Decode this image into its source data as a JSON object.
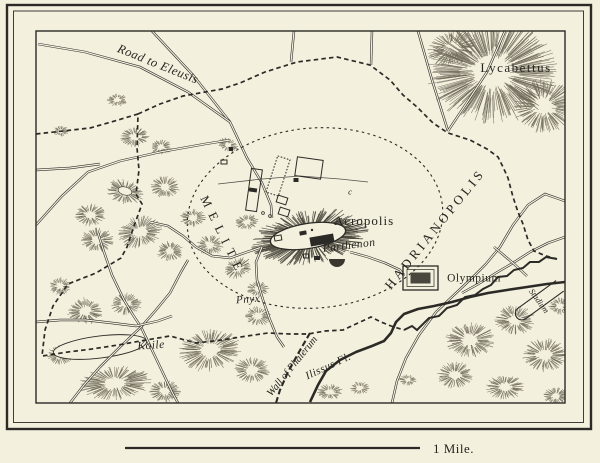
{
  "title": "Map of ancient Athens",
  "colors": {
    "background": "#f4f0de",
    "ink": "#2b2a26",
    "hachure": "#6f6a5a",
    "hachure_dark": "#4a473c",
    "label": "#26251f",
    "water": "#2b2a26"
  },
  "scale_bar": {
    "label": "1 Mile.",
    "x1": 125,
    "x2": 420,
    "y": 448,
    "label_x": 433,
    "label_y": 453,
    "size": 13
  },
  "labels": [
    {
      "id": "road-to-eleusis",
      "text": "Road to Eleusis",
      "x": 158,
      "y": 64,
      "rot": 22,
      "size": 12.5,
      "style": "italic",
      "spacing": 0.5
    },
    {
      "id": "lycabettus",
      "text": "Lycabettus",
      "x": 516,
      "y": 68,
      "rot": 0,
      "size": 13,
      "style": "roman",
      "spacing": 1.5
    },
    {
      "id": "melite",
      "text": "MELITE",
      "x": 223,
      "y": 236,
      "rot": 64,
      "size": 12.5,
      "style": "caps",
      "spacing": 7
    },
    {
      "id": "acropolis",
      "text": "Acropolis",
      "x": 364,
      "y": 221,
      "rot": 0,
      "size": 13,
      "style": "roman",
      "spacing": 1
    },
    {
      "id": "parthenon",
      "text": "Parthenon",
      "x": 349,
      "y": 245,
      "rot": -7,
      "size": 11.5,
      "style": "italic",
      "spacing": 0.5
    },
    {
      "id": "hadrianopolis",
      "text": "HADRIANOPOLIS",
      "x": 435,
      "y": 229,
      "rot": -51,
      "size": 13,
      "style": "caps",
      "spacing": 3.5
    },
    {
      "id": "olympium",
      "text": "Olympium",
      "x": 474,
      "y": 278,
      "rot": 0,
      "size": 11.5,
      "style": "roman",
      "spacing": 0.5
    },
    {
      "id": "pnyx",
      "text": "Pnyx",
      "x": 248,
      "y": 299,
      "rot": -4,
      "size": 11,
      "style": "italic",
      "spacing": 0.5
    },
    {
      "id": "koile",
      "text": "Koile",
      "x": 151,
      "y": 345,
      "rot": -4,
      "size": 11.5,
      "style": "italic",
      "spacing": 0.5
    },
    {
      "id": "wall-of-phalerum",
      "text": "Wall of Phalerum",
      "x": 292,
      "y": 366,
      "rot": -51,
      "size": 10.5,
      "style": "italic",
      "spacing": 0
    },
    {
      "id": "ilissus-fl",
      "text": "Ilissus Fl.",
      "x": 328,
      "y": 366,
      "rot": -25,
      "size": 11,
      "style": "italic",
      "spacing": 0.5
    },
    {
      "id": "stadium",
      "text": "Stadium",
      "x": 539,
      "y": 301,
      "rot": 54,
      "size": 8.5,
      "style": "italic",
      "spacing": 0
    },
    {
      "id": "map-mark-c",
      "text": "c",
      "x": 350,
      "y": 192,
      "rot": 0,
      "size": 8.5,
      "style": "italic",
      "spacing": 0
    }
  ],
  "frame": {
    "outer": {
      "x": 7,
      "y": 5,
      "w": 584,
      "h": 424,
      "sw": 2.4
    },
    "mid": {
      "x": 13.5,
      "y": 11,
      "w": 570,
      "h": 411.5,
      "sw": 0.9
    },
    "map": {
      "x": 36,
      "y": 31,
      "w": 529,
      "h": 372,
      "sw": 1.4
    }
  },
  "walls": {
    "west_south": [
      [
        36,
        134
      ],
      [
        90,
        128
      ],
      [
        118,
        120
      ],
      [
        138,
        114
      ],
      [
        137,
        148
      ],
      [
        139,
        170
      ],
      [
        136,
        194
      ],
      [
        142,
        204
      ],
      [
        134,
        226
      ],
      [
        127,
        247
      ],
      [
        121,
        258
      ],
      [
        96,
        273
      ],
      [
        68,
        284
      ],
      [
        53,
        306
      ],
      [
        45,
        330
      ],
      [
        42,
        356
      ],
      [
        68,
        352
      ],
      [
        92,
        349
      ],
      [
        118,
        345
      ],
      [
        146,
        340
      ],
      [
        170,
        336
      ],
      [
        196,
        343
      ],
      [
        222,
        340
      ],
      [
        247,
        336
      ],
      [
        268,
        333
      ],
      [
        290,
        334
      ],
      [
        308,
        334
      ],
      [
        325,
        331
      ],
      [
        343,
        330
      ],
      [
        358,
        323
      ],
      [
        371,
        317
      ],
      [
        381,
        322
      ],
      [
        391,
        326
      ],
      [
        404,
        330
      ]
    ],
    "north_east": [
      [
        138,
        114
      ],
      [
        160,
        104
      ],
      [
        183,
        96
      ],
      [
        222,
        89
      ],
      [
        240,
        83
      ],
      [
        265,
        72
      ],
      [
        297,
        62
      ],
      [
        337,
        57
      ],
      [
        370,
        65
      ],
      [
        390,
        80
      ],
      [
        403,
        95
      ],
      [
        417,
        107
      ],
      [
        427,
        117
      ],
      [
        433,
        123
      ],
      [
        448,
        133
      ],
      [
        470,
        140
      ],
      [
        487,
        149
      ],
      [
        498,
        157
      ],
      [
        503,
        167
      ],
      [
        508,
        178
      ],
      [
        513,
        197
      ],
      [
        518,
        212
      ],
      [
        523,
        224
      ],
      [
        528,
        240
      ],
      [
        534,
        251
      ],
      [
        546,
        256
      ],
      [
        557,
        259
      ]
    ],
    "jagged_se": [
      [
        404,
        330
      ],
      [
        412,
        326
      ],
      [
        417,
        330
      ],
      [
        429,
        318
      ],
      [
        439,
        316
      ],
      [
        447,
        308
      ],
      [
        457,
        305
      ],
      [
        465,
        297
      ],
      [
        475,
        295
      ],
      [
        483,
        289
      ],
      [
        491,
        285
      ],
      [
        498,
        277
      ],
      [
        507,
        276
      ],
      [
        514,
        270
      ],
      [
        523,
        268
      ],
      [
        530,
        262
      ],
      [
        539,
        262
      ],
      [
        546,
        257
      ],
      [
        557,
        259
      ]
    ],
    "phalerum": [
      [
        310,
        333
      ],
      [
        299,
        352
      ],
      [
        288,
        372
      ],
      [
        280,
        390
      ],
      [
        276,
        403
      ]
    ],
    "inner_ellipse": {
      "cx": 315,
      "cy": 218,
      "rx": 128,
      "ry": 90,
      "rot": -5
    }
  },
  "roads": {
    "double": [
      [
        [
          152,
          31
        ],
        [
          193,
          75
        ],
        [
          230,
          122
        ],
        [
          247,
          158
        ],
        [
          262,
          183
        ],
        [
          271,
          205
        ],
        [
          272,
          218
        ]
      ],
      [
        [
          38,
          44
        ],
        [
          85,
          52
        ],
        [
          140,
          67
        ],
        [
          188,
          92
        ],
        [
          230,
          122
        ]
      ],
      [
        [
          36,
          225
        ],
        [
          62,
          196
        ],
        [
          88,
          172
        ],
        [
          120,
          161
        ],
        [
          160,
          152
        ],
        [
          205,
          144
        ],
        [
          230,
          140
        ]
      ],
      [
        [
          36,
          170
        ],
        [
          70,
          168
        ],
        [
          100,
          164
        ]
      ],
      [
        [
          294,
          31
        ],
        [
          291,
          62
        ]
      ],
      [
        [
          372,
          31
        ],
        [
          371,
          65
        ]
      ],
      [
        [
          418,
          31
        ],
        [
          432,
          80
        ],
        [
          448,
          131
        ]
      ],
      [
        [
          505,
          31
        ],
        [
          487,
          72
        ],
        [
          466,
          104
        ],
        [
          448,
          131
        ]
      ],
      [
        [
          565,
          201
        ],
        [
          545,
          194
        ],
        [
          528,
          205
        ],
        [
          513,
          225
        ],
        [
          500,
          247
        ],
        [
          486,
          264
        ],
        [
          473,
          277
        ],
        [
          455,
          294
        ],
        [
          436,
          312
        ],
        [
          419,
          335
        ],
        [
          406,
          358
        ],
        [
          397,
          381
        ],
        [
          392,
          403
        ]
      ],
      [
        [
          565,
          237
        ],
        [
          548,
          243
        ],
        [
          530,
          252
        ],
        [
          513,
          263
        ],
        [
          496,
          273
        ],
        [
          480,
          283
        ],
        [
          462,
          293
        ]
      ],
      [
        [
          494,
          247
        ],
        [
          513,
          263
        ],
        [
          527,
          276
        ]
      ],
      [
        [
          98,
          233
        ],
        [
          104,
          252
        ],
        [
          112,
          275
        ],
        [
          124,
          300
        ],
        [
          133,
          315
        ],
        [
          141,
          327
        ],
        [
          152,
          350
        ],
        [
          163,
          373
        ],
        [
          172,
          392
        ],
        [
          178,
          403
        ]
      ],
      [
        [
          70,
          403
        ],
        [
          84,
          385
        ],
        [
          100,
          367
        ],
        [
          120,
          347
        ],
        [
          141,
          327
        ],
        [
          156,
          310
        ],
        [
          170,
          293
        ],
        [
          181,
          272
        ],
        [
          188,
          260
        ]
      ],
      [
        [
          36,
          322
        ],
        [
          60,
          320
        ],
        [
          86,
          320
        ],
        [
          112,
          323
        ],
        [
          136,
          326
        ],
        [
          158,
          321
        ],
        [
          172,
          316
        ]
      ],
      [
        [
          150,
          222
        ],
        [
          168,
          226
        ],
        [
          183,
          236
        ],
        [
          196,
          247
        ],
        [
          212,
          256
        ],
        [
          230,
          258
        ],
        [
          247,
          252
        ],
        [
          262,
          247
        ]
      ],
      [
        [
          262,
          247
        ],
        [
          256,
          262
        ],
        [
          257,
          280
        ],
        [
          263,
          300
        ],
        [
          270,
          320
        ],
        [
          277,
          337
        ],
        [
          284,
          347
        ]
      ],
      [
        [
          350,
          252
        ],
        [
          368,
          257
        ],
        [
          385,
          263
        ],
        [
          400,
          270
        ],
        [
          404,
          276
        ]
      ]
    ],
    "single": [
      [
        [
          218,
          184
        ],
        [
          262,
          179
        ],
        [
          300,
          176
        ],
        [
          340,
          179
        ],
        [
          368,
          182
        ]
      ]
    ]
  },
  "river": [
    [
      310,
      402
    ],
    [
      318,
      385
    ],
    [
      326,
      371
    ],
    [
      340,
      360
    ],
    [
      356,
      352
    ],
    [
      372,
      346
    ],
    [
      384,
      341
    ],
    [
      391,
      333
    ],
    [
      396,
      322
    ],
    [
      404,
      314
    ],
    [
      418,
      309
    ],
    [
      434,
      306
    ],
    [
      452,
      302
    ],
    [
      470,
      297
    ],
    [
      488,
      293
    ],
    [
      507,
      290
    ],
    [
      527,
      287
    ],
    [
      547,
      284
    ],
    [
      565,
      282
    ]
  ],
  "hills": [
    [
      117,
      100,
      9,
      6,
      0,
      0,
      1
    ],
    [
      61,
      131,
      7,
      5,
      0,
      0,
      1
    ],
    [
      135,
      137,
      13,
      9,
      -10,
      0,
      1
    ],
    [
      161,
      147,
      10,
      7,
      0,
      0,
      1
    ],
    [
      228,
      145,
      10,
      6,
      20,
      0,
      0.9
    ],
    [
      165,
      187,
      13,
      10,
      0,
      0,
      1
    ],
    [
      125,
      192,
      17,
      11,
      15,
      0,
      1
    ],
    [
      90,
      215,
      14,
      10,
      0,
      0,
      1
    ],
    [
      140,
      232,
      20,
      14,
      -15,
      0,
      1
    ],
    [
      97,
      240,
      15,
      11,
      0,
      0,
      1
    ],
    [
      193,
      218,
      12,
      8,
      0,
      0,
      1
    ],
    [
      210,
      245,
      12,
      9,
      0,
      0,
      1
    ],
    [
      170,
      251,
      12,
      9,
      0,
      0,
      1
    ],
    [
      238,
      268,
      13,
      9,
      -20,
      0,
      1
    ],
    [
      258,
      289,
      10,
      7,
      0,
      0,
      0.9
    ],
    [
      247,
      222,
      11,
      7,
      -10,
      0,
      1
    ],
    [
      60,
      286,
      10,
      8,
      0,
      0,
      1
    ],
    [
      85,
      311,
      16,
      12,
      0,
      0,
      1
    ],
    [
      126,
      304,
      14,
      10,
      0,
      0,
      1
    ],
    [
      60,
      355,
      12,
      9,
      0,
      0,
      1
    ],
    [
      115,
      383,
      32,
      15,
      -5,
      0,
      1
    ],
    [
      165,
      391,
      14,
      10,
      0,
      0,
      1
    ],
    [
      210,
      350,
      28,
      19,
      -10,
      0,
      1
    ],
    [
      252,
      370,
      16,
      12,
      0,
      0,
      1
    ],
    [
      258,
      316,
      12,
      9,
      0,
      0,
      0.9
    ],
    [
      330,
      392,
      12,
      7,
      0,
      0,
      0.9
    ],
    [
      360,
      388,
      9,
      6,
      0,
      0,
      0.9
    ],
    [
      408,
      380,
      8,
      5,
      0,
      0,
      0.9
    ],
    [
      492,
      72,
      58,
      46,
      0,
      0,
      1.15
    ],
    [
      543,
      106,
      28,
      24,
      0,
      0,
      1
    ],
    [
      452,
      48,
      22,
      16,
      -20,
      0,
      0.9
    ],
    [
      470,
      340,
      22,
      16,
      0,
      0,
      1
    ],
    [
      515,
      320,
      18,
      13,
      0,
      0,
      1
    ],
    [
      545,
      355,
      20,
      15,
      0,
      0,
      1
    ],
    [
      455,
      375,
      16,
      12,
      0,
      0,
      1
    ],
    [
      505,
      387,
      17,
      11,
      0,
      0,
      1
    ],
    [
      556,
      396,
      12,
      8,
      0,
      0,
      1
    ],
    [
      560,
      306,
      10,
      8,
      0,
      0,
      1
    ],
    [
      310,
      237,
      52,
      24,
      -9,
      1,
      1.25
    ]
  ],
  "white_patches": [
    [
      308,
      236,
      38,
      12.5,
      -9,
      1.3
    ],
    [
      100,
      347,
      47,
      11,
      -7,
      0.9
    ],
    [
      488,
      63,
      9,
      7,
      0,
      0
    ],
    [
      125,
      191,
      7,
      4,
      15,
      0.6
    ]
  ],
  "structures": {
    "agora_rects": [
      [
        254,
        190,
        11,
        42,
        8,
        0
      ],
      [
        278,
        176,
        13,
        38,
        18,
        2
      ],
      [
        309,
        168,
        26,
        19,
        8,
        0
      ],
      [
        282,
        200,
        10,
        7,
        18,
        0
      ],
      [
        284,
        212,
        10,
        7,
        18,
        0
      ],
      [
        296,
        180,
        5,
        4,
        0,
        1
      ],
      [
        224,
        162,
        6,
        4,
        0,
        0
      ],
      [
        231,
        149,
        4,
        4,
        0,
        1
      ],
      [
        253,
        190,
        8,
        4,
        8,
        1
      ]
    ],
    "acropolis_buildings": [
      [
        322,
        240,
        24,
        9,
        -10,
        1
      ],
      [
        303,
        233,
        7,
        4,
        -10,
        1
      ],
      [
        317,
        258,
        6,
        4,
        0,
        1
      ],
      [
        306,
        256,
        5,
        4,
        0,
        0
      ],
      [
        278,
        238,
        7,
        5,
        -10,
        0
      ]
    ],
    "theater": {
      "cx": 337,
      "cy": 259,
      "r": 8
    },
    "summit_dot": [
      312,
      230
    ],
    "circles": [
      [
        263,
        213
      ],
      [
        270,
        216
      ]
    ],
    "olympium": {
      "x": 403,
      "y": 266,
      "w": 35,
      "h": 24
    },
    "stadium": {
      "cx": 539,
      "cy": 301,
      "rot": 54,
      "w": 13,
      "len": 47
    }
  }
}
